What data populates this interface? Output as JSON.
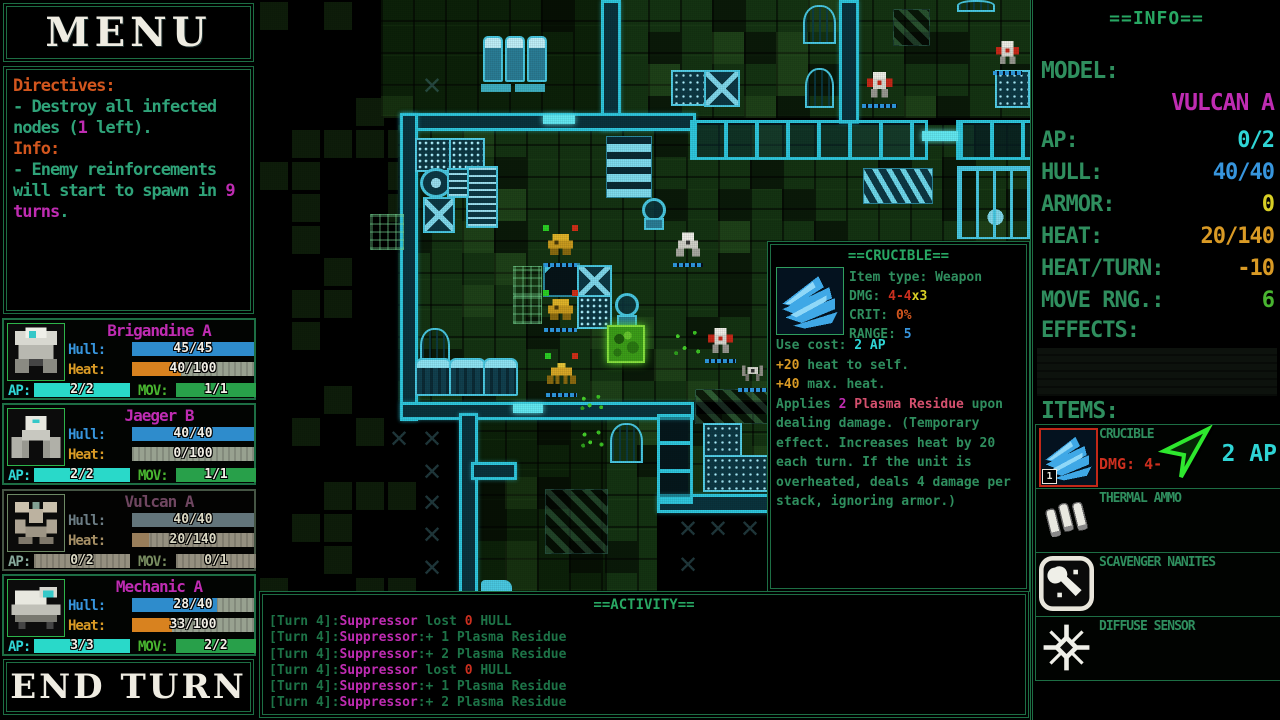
{
  "menu": {
    "title": "MENU"
  },
  "end_turn_label": "END TURN",
  "directives": {
    "lines": [
      [
        [
          "Directives:",
          "o"
        ]
      ],
      [
        [
          "- Destroy all infected",
          "t"
        ]
      ],
      [
        [
          "nodes (",
          "t"
        ],
        [
          "1",
          "m"
        ],
        [
          " left).",
          "t"
        ]
      ],
      [
        [
          "Info:",
          "o"
        ]
      ],
      [
        [
          "- Enemy reinforcements",
          "t"
        ]
      ],
      [
        [
          "will start to spawn in ",
          "t"
        ],
        [
          "9",
          "m"
        ]
      ],
      [
        [
          "turns",
          "m"
        ],
        [
          ".",
          "t"
        ]
      ]
    ]
  },
  "unit_labels": {
    "hull": "Hull:",
    "heat": "Heat:",
    "ap": "AP:",
    "mov": "MOV:"
  },
  "units": [
    {
      "name": "Brigandine A",
      "portrait": "brigandine",
      "dimmed": false,
      "hull": {
        "text": "45/45",
        "pct": 100
      },
      "heat": {
        "text": "40/100",
        "pct": 40
      },
      "ap": {
        "text": "2/2",
        "pct": 100
      },
      "mov": {
        "text": "1/1",
        "pct": 100
      }
    },
    {
      "name": "Jaeger B",
      "portrait": "jaeger",
      "dimmed": false,
      "hull": {
        "text": "40/40",
        "pct": 100
      },
      "heat": {
        "text": "0/100",
        "pct": 0
      },
      "ap": {
        "text": "2/2",
        "pct": 100
      },
      "mov": {
        "text": "1/1",
        "pct": 100
      }
    },
    {
      "name": "Vulcan A",
      "portrait": "vulcan",
      "dimmed": true,
      "hull": {
        "text": "40/40",
        "pct": 100
      },
      "heat": {
        "text": "20/140",
        "pct": 14
      },
      "ap": {
        "text": "0/2",
        "pct": 0
      },
      "mov": {
        "text": "0/1",
        "pct": 0
      }
    },
    {
      "name": "Mechanic A",
      "portrait": "mechanic",
      "dimmed": false,
      "hull": {
        "text": "28/40",
        "pct": 70
      },
      "heat": {
        "text": "33/100",
        "pct": 33
      },
      "ap": {
        "text": "3/3",
        "pct": 100
      },
      "mov": {
        "text": "2/2",
        "pct": 100
      }
    }
  ],
  "info": {
    "title": "==INFO==",
    "model_label": "MODEL:",
    "model_value": "VULCAN A",
    "stats": [
      {
        "label": "AP:",
        "value": "0/2",
        "color": "c"
      },
      {
        "label": "HULL:",
        "value": "40/40",
        "color": "b"
      },
      {
        "label": "ARMOR:",
        "value": "0",
        "color": "y"
      },
      {
        "label": "HEAT:",
        "value": "20/140",
        "color": "am"
      },
      {
        "label": "HEAT/TURN:",
        "value": "-10",
        "color": "am"
      },
      {
        "label": "MOVE RNG.:",
        "value": "6",
        "color": "li"
      }
    ],
    "effects_label": "EFFECTS:",
    "items_label": "ITEMS:",
    "items": [
      {
        "name": "CRUCIBLE",
        "icon": "claw",
        "selected": true,
        "slot": "1",
        "dmg_label": "DMG:",
        "dmg_value": "4-",
        "ap_cost": "2 AP",
        "cursor": true
      },
      {
        "name": "THERMAL AMMO",
        "icon": "ammo",
        "selected": false
      },
      {
        "name": "SCAVENGER NANITES",
        "icon": "wrench",
        "selected": false
      },
      {
        "name": "DIFFUSE SENSOR",
        "icon": "sensor",
        "selected": false
      }
    ]
  },
  "tooltip": {
    "title": "==CRUCIBLE==",
    "icon": "claw",
    "stat_lines": [
      [
        [
          "Item type: Weapon",
          "g"
        ]
      ],
      [
        [
          "DMG: ",
          "g"
        ],
        [
          "4-4",
          "r"
        ],
        [
          "x3",
          "y"
        ]
      ],
      [
        [
          "CRIT: ",
          "g"
        ],
        [
          "0%",
          "o"
        ]
      ],
      [
        [
          "RANGE: ",
          "g"
        ],
        [
          "5",
          "b"
        ]
      ]
    ],
    "body_lines": [
      [
        [
          "Use cost: ",
          "g"
        ],
        [
          "2 AP",
          "c"
        ]
      ],
      [
        [
          "+20",
          "am"
        ],
        [
          " heat to self.",
          "g"
        ]
      ],
      [
        [
          "+40",
          "am"
        ],
        [
          " max. heat.",
          "g"
        ]
      ],
      [
        [
          "Applies ",
          "g"
        ],
        [
          "2 ",
          "m"
        ],
        [
          "Plasma Residue",
          "pk"
        ],
        [
          " upon",
          "g"
        ]
      ],
      [
        [
          "dealing damage. (Temporary",
          "g"
        ]
      ],
      [
        [
          "effect. Increases heat by 20",
          "g"
        ]
      ],
      [
        [
          "each turn. If the unit is",
          "g"
        ]
      ],
      [
        [
          "overheated, deals 4 damage per",
          "g"
        ]
      ],
      [
        [
          "stack, ignoring armor.)",
          "g"
        ]
      ]
    ]
  },
  "activity": {
    "title": "==ACTIVITY==",
    "lines": [
      [
        [
          "[Turn 4]:",
          "dg"
        ],
        [
          "Suppressor",
          "m"
        ],
        [
          " lost ",
          "dg"
        ],
        [
          "0",
          "r"
        ],
        [
          " HULL",
          "dg"
        ]
      ],
      [
        [
          "[Turn 4]:",
          "dg"
        ],
        [
          "Suppressor",
          "m"
        ],
        [
          ":+ 1 Plasma Residue",
          "dg"
        ]
      ],
      [
        [
          "[Turn 4]:",
          "dg"
        ],
        [
          "Suppressor",
          "m"
        ],
        [
          ":+ 2 Plasma Residue",
          "dg"
        ]
      ],
      [
        [
          "[Turn 4]:",
          "dg"
        ],
        [
          "Suppressor",
          "m"
        ],
        [
          " lost ",
          "dg"
        ],
        [
          "0",
          "r"
        ],
        [
          " HULL",
          "dg"
        ]
      ],
      [
        [
          "[Turn 4]:",
          "dg"
        ],
        [
          "Suppressor",
          "m"
        ],
        [
          ":+ 1 Plasma Residue",
          "dg"
        ]
      ],
      [
        [
          "[Turn 4]:",
          "dg"
        ],
        [
          "Suppressor",
          "m"
        ],
        [
          ":+ 2 Plasma Residue",
          "dg"
        ]
      ]
    ]
  },
  "map": {
    "floors": [
      {
        "x": 123,
        "y": 0,
        "w": 220,
        "h": 118,
        "dim": true
      },
      {
        "x": 358,
        "y": 0,
        "w": 414,
        "h": 118,
        "dim": false
      },
      {
        "x": 140,
        "y": 125,
        "w": 632,
        "h": 277,
        "dim": false
      },
      {
        "x": 215,
        "y": 413,
        "w": 132,
        "h": 179,
        "dim": true
      },
      {
        "x": 347,
        "y": 413,
        "w": 52,
        "h": 179,
        "dim": false
      },
      {
        "x": 430,
        "y": 414,
        "w": 82,
        "h": 83,
        "dim": false
      }
    ],
    "patch_zone": {
      "x": 0,
      "y": 0,
      "w": 140,
      "h": 592
    },
    "walls": [
      {
        "x": 343,
        "y": 0,
        "w": 14,
        "h": 125
      },
      {
        "x": 142,
        "y": 113,
        "w": 290,
        "h": 12
      },
      {
        "x": 581,
        "y": 0,
        "w": 14,
        "h": 118
      },
      {
        "x": 142,
        "y": 113,
        "w": 12,
        "h": 302
      },
      {
        "x": 142,
        "y": 402,
        "w": 288,
        "h": 12
      },
      {
        "x": 201,
        "y": 413,
        "w": 13,
        "h": 179
      },
      {
        "x": 213,
        "y": 462,
        "w": 40,
        "h": 12
      },
      {
        "x": 399,
        "y": 494,
        "w": 113,
        "h": 13
      }
    ],
    "fences": [
      {
        "x": 432,
        "y": 120,
        "w": 232,
        "h": 34,
        "dir": "h"
      },
      {
        "x": 698,
        "y": 120,
        "w": 74,
        "h": 34,
        "dir": "h"
      },
      {
        "x": 399,
        "y": 414,
        "w": 30,
        "h": 84,
        "dir": "v"
      }
    ],
    "doors": [
      {
        "x": 285,
        "y": 115,
        "w": 32,
        "h": 9
      },
      {
        "x": 255,
        "y": 404,
        "w": 30,
        "h": 9
      },
      {
        "x": 664,
        "y": 131,
        "w": 36,
        "h": 10
      }
    ],
    "machines": [
      {
        "t": "tank",
        "x": 225,
        "y": 36,
        "w": 16,
        "h": 42
      },
      {
        "t": "tank",
        "x": 247,
        "y": 36,
        "w": 16,
        "h": 42
      },
      {
        "t": "tank",
        "x": 269,
        "y": 36,
        "w": 16,
        "h": 42
      },
      {
        "t": "bar",
        "x": 223,
        "y": 84,
        "w": 30,
        "h": 8
      },
      {
        "t": "bar",
        "x": 257,
        "y": 84,
        "w": 30,
        "h": 8
      },
      {
        "t": "dot",
        "x": 157,
        "y": 138,
        "w": 33,
        "h": 30
      },
      {
        "t": "dot",
        "x": 191,
        "y": 138,
        "w": 32,
        "h": 30
      },
      {
        "t": "dial",
        "x": 162,
        "y": 168,
        "w": 26,
        "h": 24
      },
      {
        "t": "rack",
        "x": 208,
        "y": 166,
        "w": 28,
        "h": 58
      },
      {
        "t": "rack",
        "x": 189,
        "y": 168,
        "w": 18,
        "h": 26
      },
      {
        "t": "x",
        "x": 165,
        "y": 197,
        "w": 28,
        "h": 32
      },
      {
        "t": "chips",
        "x": 348,
        "y": 136,
        "w": 44,
        "h": 60
      },
      {
        "t": "turret",
        "x": 382,
        "y": 198,
        "w": 28,
        "h": 32
      },
      {
        "t": "turret",
        "x": 355,
        "y": 293,
        "w": 28,
        "h": 34
      },
      {
        "t": "crate",
        "x": 413,
        "y": 70,
        "w": 31,
        "h": 32
      },
      {
        "t": "x",
        "x": 446,
        "y": 70,
        "w": 32,
        "h": 33
      },
      {
        "t": "arch",
        "x": 545,
        "y": 5,
        "w": 29,
        "h": 35
      },
      {
        "t": "arch",
        "x": 547,
        "y": 68,
        "w": 25,
        "h": 36
      },
      {
        "t": "arch",
        "x": 699,
        "y": 0,
        "w": 34,
        "h": 8
      },
      {
        "t": "dark",
        "x": 285,
        "y": 263,
        "w": 33,
        "h": 30
      },
      {
        "t": "x",
        "x": 319,
        "y": 265,
        "w": 31,
        "h": 28
      },
      {
        "t": "dot",
        "x": 319,
        "y": 295,
        "w": 31,
        "h": 30
      },
      {
        "t": "barrels",
        "x": 605,
        "y": 168,
        "w": 68,
        "h": 34
      },
      {
        "t": "gantry",
        "x": 699,
        "y": 166,
        "w": 73,
        "h": 66
      },
      {
        "t": "crate",
        "x": 737,
        "y": 70,
        "w": 31,
        "h": 34
      },
      {
        "t": "arch",
        "x": 162,
        "y": 328,
        "w": 26,
        "h": 34
      },
      {
        "t": "bus",
        "x": 157,
        "y": 358,
        "w": 33,
        "h": 34
      },
      {
        "t": "bus",
        "x": 191,
        "y": 358,
        "w": 33,
        "h": 34
      },
      {
        "t": "bus",
        "x": 225,
        "y": 358,
        "w": 31,
        "h": 34
      },
      {
        "t": "arch",
        "x": 352,
        "y": 423,
        "w": 29,
        "h": 36
      },
      {
        "t": "crate",
        "x": 445,
        "y": 423,
        "w": 35,
        "h": 31
      },
      {
        "t": "crate",
        "x": 445,
        "y": 455,
        "w": 65,
        "h": 33
      },
      {
        "t": "hash",
        "x": 255,
        "y": 266,
        "w": 27,
        "h": 28
      },
      {
        "t": "hash",
        "x": 255,
        "y": 296,
        "w": 27,
        "h": 26
      },
      {
        "t": "hash",
        "x": 112,
        "y": 214,
        "w": 32,
        "h": 34
      },
      {
        "t": "vehicle",
        "x": 223,
        "y": 580,
        "w": 31,
        "h": 13
      }
    ],
    "hazards": [
      {
        "x": 287,
        "y": 489,
        "w": 61,
        "h": 63
      },
      {
        "x": 437,
        "y": 389,
        "w": 73,
        "h": 33
      },
      {
        "x": 635,
        "y": 9,
        "w": 35,
        "h": 35
      }
    ],
    "xmarks": [
      {
        "x": 161,
        "y": 72
      },
      {
        "x": 128,
        "y": 425
      },
      {
        "x": 161,
        "y": 425
      },
      {
        "x": 161,
        "y": 458
      },
      {
        "x": 161,
        "y": 489
      },
      {
        "x": 161,
        "y": 521
      },
      {
        "x": 161,
        "y": 554
      },
      {
        "x": 417,
        "y": 515
      },
      {
        "x": 447,
        "y": 515
      },
      {
        "x": 479,
        "y": 515
      },
      {
        "x": 417,
        "y": 551
      }
    ],
    "node": {
      "x": 349,
      "y": 325,
      "w": 34,
      "h": 34
    },
    "speckles": [
      {
        "x": 413,
        "y": 326,
        "w": 34,
        "h": 34
      },
      {
        "x": 320,
        "y": 393,
        "w": 29,
        "h": 19
      },
      {
        "x": 321,
        "y": 428,
        "w": 28,
        "h": 22
      }
    ],
    "units": [
      {
        "kind": "gold",
        "x": 285,
        "y": 230,
        "w": 35,
        "h": 33,
        "player": true,
        "id": "player-mech-1"
      },
      {
        "kind": "gold",
        "x": 285,
        "y": 295,
        "w": 35,
        "h": 33,
        "player": true,
        "id": "player-mech-2"
      },
      {
        "kind": "quad",
        "x": 287,
        "y": 358,
        "w": 33,
        "h": 35,
        "player": true,
        "id": "player-mech-3"
      },
      {
        "kind": "white",
        "x": 414,
        "y": 230,
        "w": 32,
        "h": 33,
        "player": false,
        "id": "enemy-1"
      },
      {
        "kind": "whitered",
        "x": 446,
        "y": 326,
        "w": 33,
        "h": 33,
        "player": false,
        "id": "enemy-2"
      },
      {
        "kind": "spider",
        "x": 479,
        "y": 360,
        "w": 31,
        "h": 28,
        "player": false,
        "id": "enemy-3"
      },
      {
        "kind": "whitered",
        "x": 603,
        "y": 70,
        "w": 37,
        "h": 34,
        "player": false,
        "id": "enemy-4"
      },
      {
        "kind": "whitered",
        "x": 734,
        "y": 38,
        "w": 31,
        "h": 33,
        "player": false,
        "id": "enemy-5"
      }
    ]
  }
}
